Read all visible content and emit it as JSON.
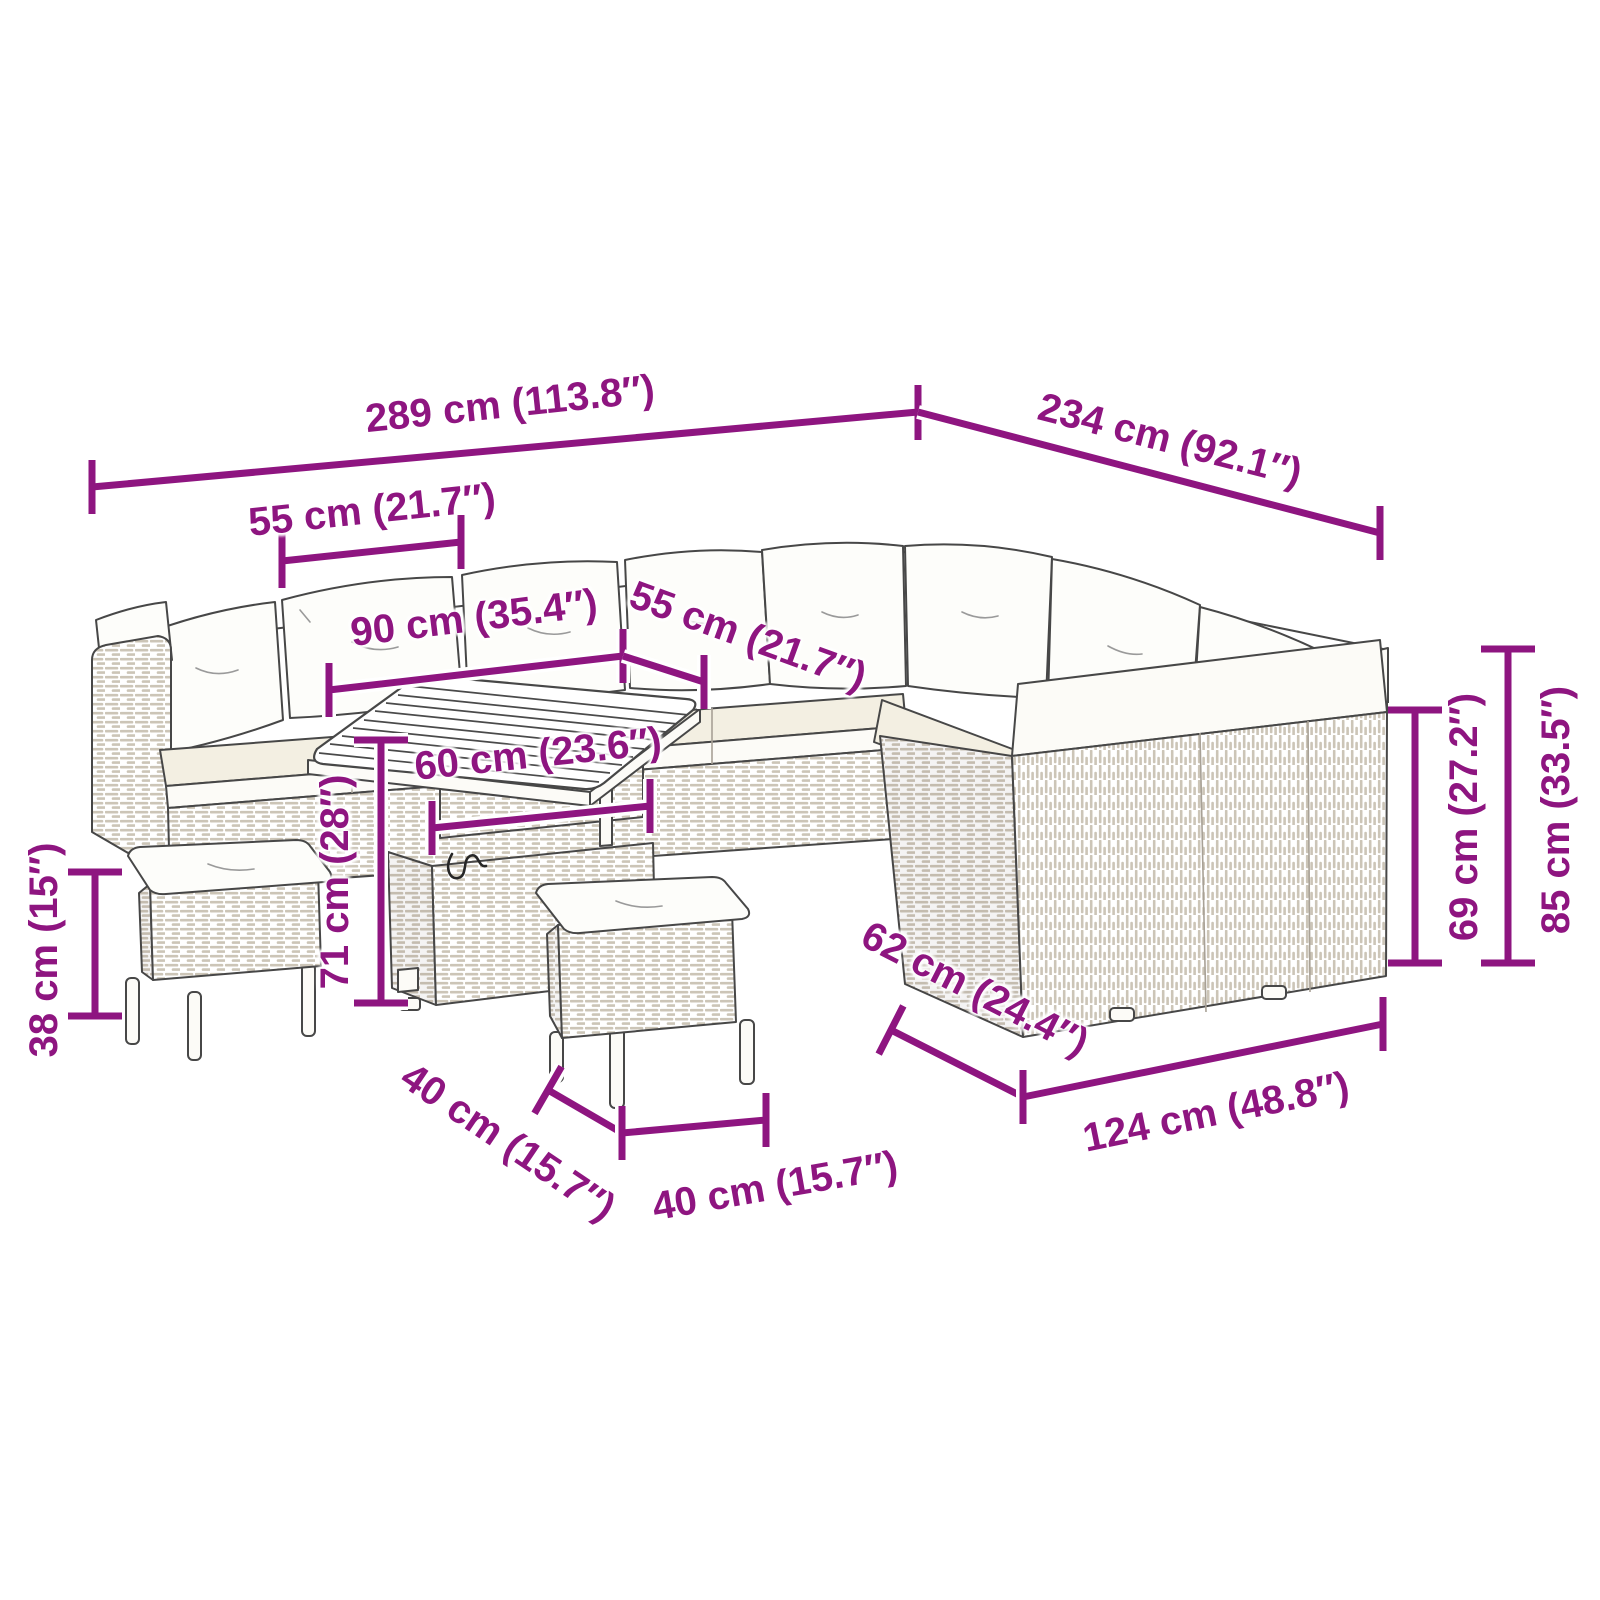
{
  "meta": {
    "accent_color": "#8E1580",
    "background_color": "#ffffff",
    "illustration": "rattan-garden-lounge-set-with-table-and-stools"
  },
  "dimensions": {
    "overall_width": {
      "cm": 289,
      "inch": 113.8,
      "label": "289 cm (113.8″)"
    },
    "overall_depth": {
      "cm": 234,
      "inch": 92.1,
      "label": "234 cm (92.1″)"
    },
    "section_width_left": {
      "cm": 55,
      "inch": 21.7,
      "label": "55 cm (21.7″)"
    },
    "table_length": {
      "cm": 90,
      "inch": 35.4,
      "label": "90 cm (35.4″)"
    },
    "section_width_middle": {
      "cm": 55,
      "inch": 21.7,
      "label": "55 cm (21.7″)"
    },
    "table_depth": {
      "cm": 60,
      "inch": 23.6,
      "label": "60 cm (23.6″)"
    },
    "table_height": {
      "cm": 71,
      "inch": 28,
      "label": "71 cm (28″)"
    },
    "stool_height": {
      "cm": 38,
      "inch": 15,
      "label": "38 cm (15″)"
    },
    "stool_depth": {
      "cm": 40,
      "inch": 15.7,
      "label": "40 cm (15.7″)"
    },
    "stool_width": {
      "cm": 40,
      "inch": 15.7,
      "label": "40 cm (15.7″)"
    },
    "sofa_depth": {
      "cm": 62,
      "inch": 24.4,
      "label": "62 cm (24.4″)"
    },
    "sofa_right_length": {
      "cm": 124,
      "inch": 48.8,
      "label": "124 cm (48.8″)"
    },
    "seat_height": {
      "cm": 69,
      "inch": 27.2,
      "label": "69 cm (27.2″)"
    },
    "back_height": {
      "cm": 85,
      "inch": 33.5,
      "label": "85 cm (33.5″)"
    }
  }
}
